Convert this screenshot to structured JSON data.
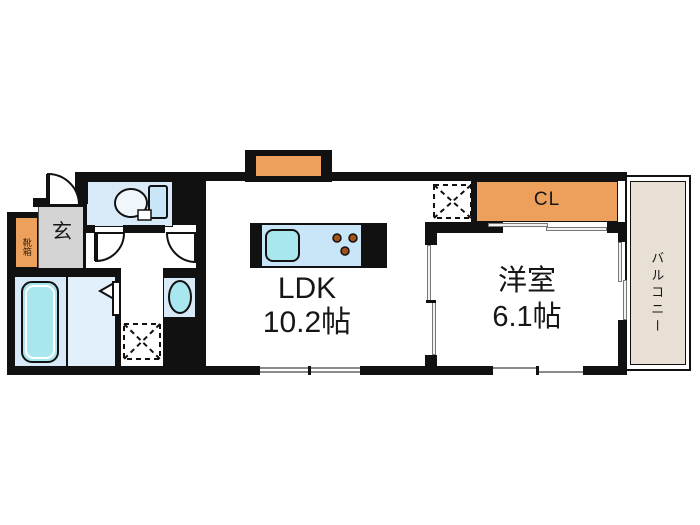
{
  "rooms": {
    "ldk": {
      "label": "LDK",
      "area": "10.2帖"
    },
    "western": {
      "label": "洋室",
      "area": "6.1帖"
    },
    "closet": {
      "label": "CL"
    },
    "balcony": {
      "label": "バルコニー"
    },
    "entrance": {
      "label": "玄"
    },
    "shoebox": {
      "label": "靴箱"
    }
  },
  "colors": {
    "wall": "#111111",
    "accent_orange": "#EDA05C",
    "room_blue": "#D8EAF8",
    "room_blue_light": "#E2F0FB",
    "fixture_aqua": "#A9E7EF",
    "counter_blue": "#C9E6F8",
    "entrance_gray": "#D4D4D4",
    "balcony_beige": "#E8E0D5",
    "burner_brown": "#A45117"
  }
}
